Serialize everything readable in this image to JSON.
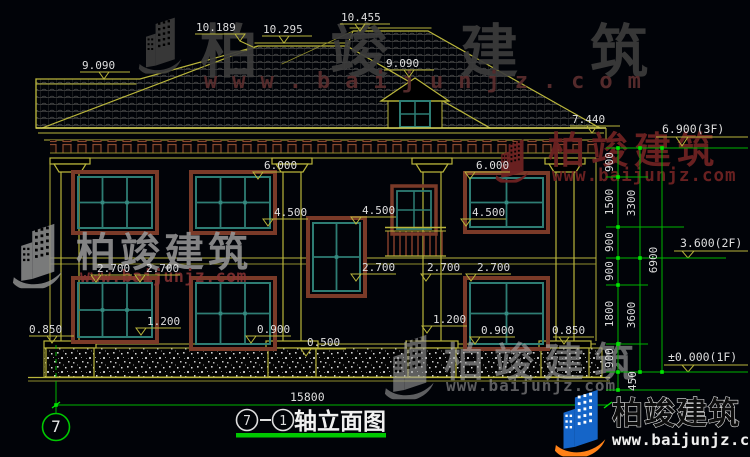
{
  "colors": {
    "background": "#010308",
    "cad_line_yellow": "#b9b53b",
    "dim_green": "#00b400",
    "marker_green": "#00e400",
    "window_teal": "#2e7d74",
    "frame_brown": "#7a3a28",
    "dim_text_white": "#dedede",
    "watermark_red": "#6e2222",
    "watermark_gray": "#9a9a9a",
    "logo_blue": "#1565c8",
    "logo_orange": "#ff8218"
  },
  "title_block": {
    "full": "⑦-①轴立面图",
    "axis_from": "7",
    "axis_to": "1",
    "suffix": "轴立面图",
    "axis_bubble": "7",
    "dash": "—"
  },
  "dimensions": {
    "overall_width": "15800",
    "roof": {
      "r1": "10.189",
      "r2": "10.295",
      "r3": "10.455",
      "left_eave": "9.090",
      "dormer": "9.090",
      "eave_right": "7.440"
    },
    "levels": {
      "f3": "6.900(3F)",
      "f2": "3.600(2F)",
      "f1": "±0.000(1F)"
    },
    "elev": {
      "e6000a": "6.000",
      "e6000b": "6.000",
      "e4500a": "4.500",
      "e4500b": "4.500",
      "e4500c": "4.500",
      "e2700a": "2.700",
      "e2700b": "2.700",
      "e2700c": "2.700",
      "e2700d": "2.700",
      "e2700e": "2.700",
      "e1200a": "1.200",
      "e1200b": "1.200",
      "e0900a": "0.900",
      "e0900b": "0.900",
      "e0850a": "0.850",
      "e0850b": "0.850",
      "e0500": "0.500"
    },
    "chain_inner": {
      "a": "900",
      "b": "1500",
      "c": "900",
      "d": "900",
      "e": "1800",
      "f": "900",
      "g": "450"
    },
    "chain_mid": {
      "a": "3300",
      "b": "3600"
    },
    "chain_outer": {
      "a": "6900"
    }
  },
  "watermark": {
    "brand": "柏竣建筑",
    "url": "www.baijunjz.com"
  }
}
